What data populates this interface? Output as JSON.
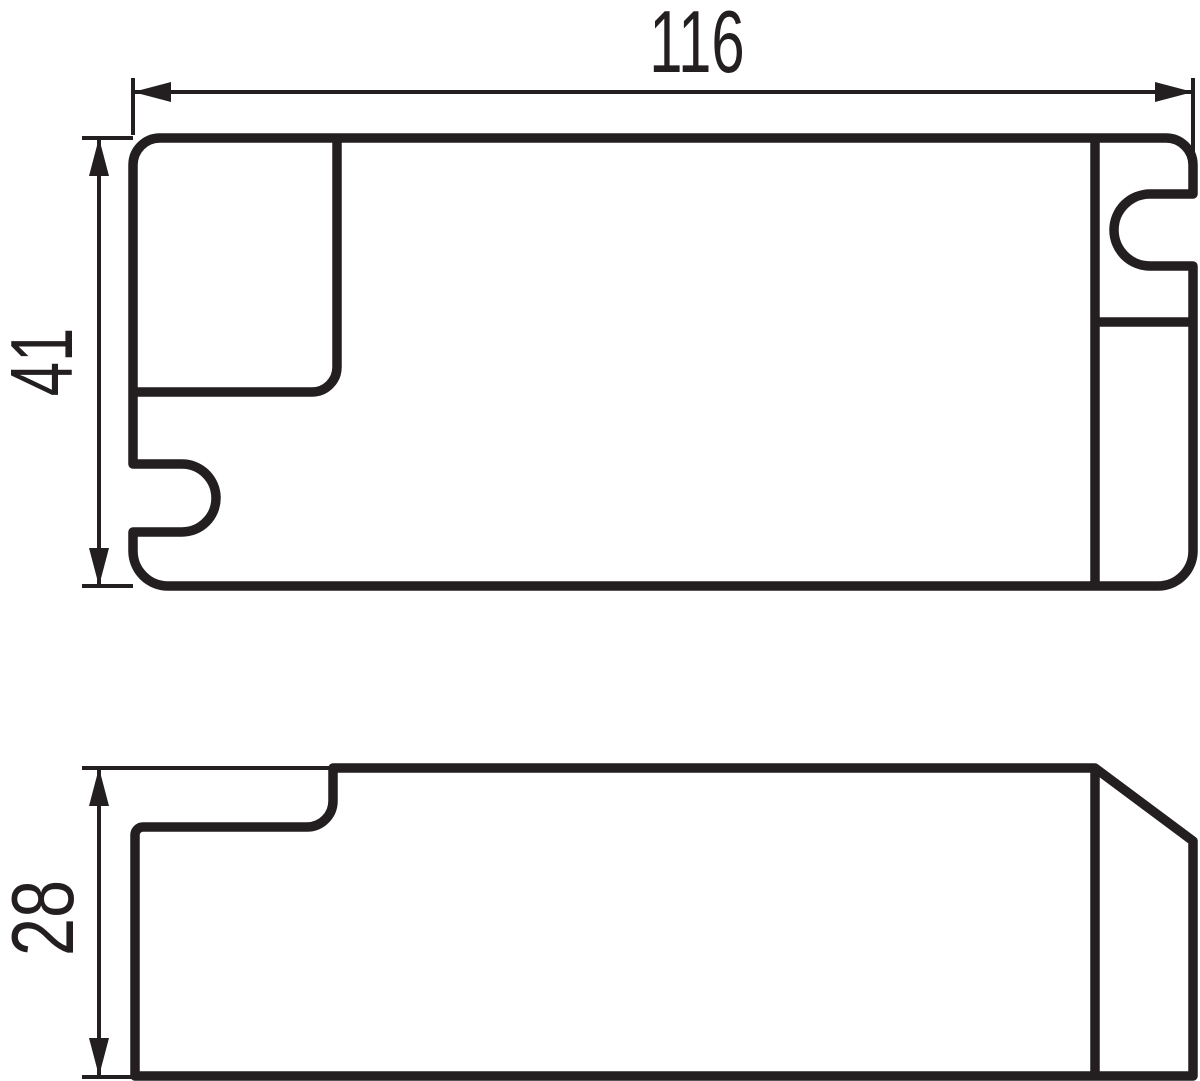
{
  "drawing": {
    "type": "technical-dimension-drawing",
    "dimensions": {
      "width": {
        "value": "116"
      },
      "height": {
        "value": "41"
      },
      "depth": {
        "value": "28"
      }
    },
    "colors": {
      "line": "#231f20",
      "background": "#ffffff"
    }
  }
}
